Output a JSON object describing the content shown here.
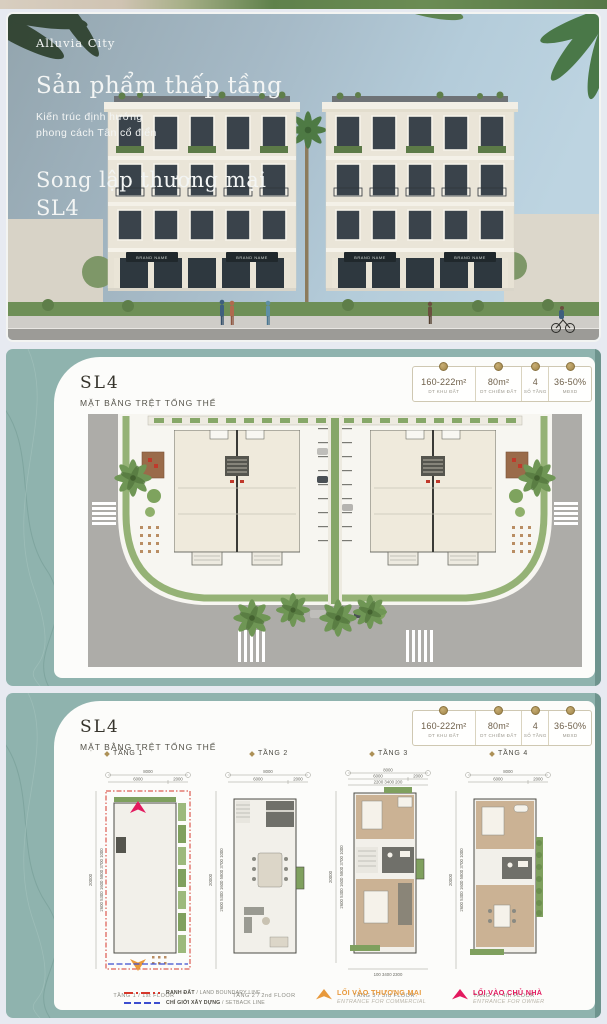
{
  "colors": {
    "teal_bg": "#8FB3AE",
    "teal_edge": "#6E948E",
    "gap": "#E7EAF1",
    "accent_gold": "#AD9157",
    "boundary_red": "#D6382C",
    "setback_blue": "#3D4ECF",
    "commercial_orange": "#E8993B",
    "owner_pink": "#E31A5F"
  },
  "hero": {
    "brand": "Alluvia City",
    "title": "Sản phẩm thấp tầng",
    "tagline1": "Kiến trúc định hướng",
    "tagline2": "phong cách Tân cổ điển",
    "product1": "Song lập thương mại",
    "product2": "SL4",
    "sign": "BRAND NAME"
  },
  "stats": {
    "items": [
      {
        "value": "160-222m²",
        "label": "DT KHU ĐẤT"
      },
      {
        "value": "80m²",
        "label": "DT CHIẾM ĐẤT"
      },
      {
        "value": "4",
        "label": "SỐ TẦNG"
      },
      {
        "value": "36-50%",
        "label": "MĐXD"
      }
    ]
  },
  "sections": {
    "site": {
      "code": "SL4",
      "subtitle": "MẶT BẰNG TRỆT TỔNG THỂ"
    },
    "floors": {
      "code": "SL4",
      "subtitle": "MẶT BẰNG TRỆT TỔNG THỂ"
    }
  },
  "floors": {
    "tabs": [
      "TẦNG 1",
      "TẦNG 2",
      "TẦNG 3",
      "TẦNG 4"
    ],
    "captions": [
      "TẦNG 1 / 1st FLOOR",
      "TẦNG 2 / 2nd FLOOR",
      "TẦNG 3 / 3rd FLOOR",
      "TẦNG 4 / 4th FLOOR"
    ]
  },
  "dims": {
    "total_w": "8000",
    "w_main": "6000",
    "w_side": "2000",
    "total_h": "20000",
    "left_stack": "2600   5300   1600   5800   3700   1000",
    "t3_top": "2200   3400   200",
    "t3_bottom": "100   3400   2300"
  },
  "legend": {
    "boundary_vi": "RANH ĐẤT",
    "boundary_en": " / LAND BOUNDARY LINE",
    "setback_vi": "CHỈ GIỚI XÂY DỰNG",
    "setback_en": " / SETBACK LINE",
    "commercial_vi": "LỐI VÀO THƯƠNG MẠI",
    "commercial_en": "ENTRANCE FOR COMMERCIAL",
    "owner_vi": "LỐI VÀO CHỦ NHÀ",
    "owner_en": "ENTRANCE FOR OWNER"
  }
}
